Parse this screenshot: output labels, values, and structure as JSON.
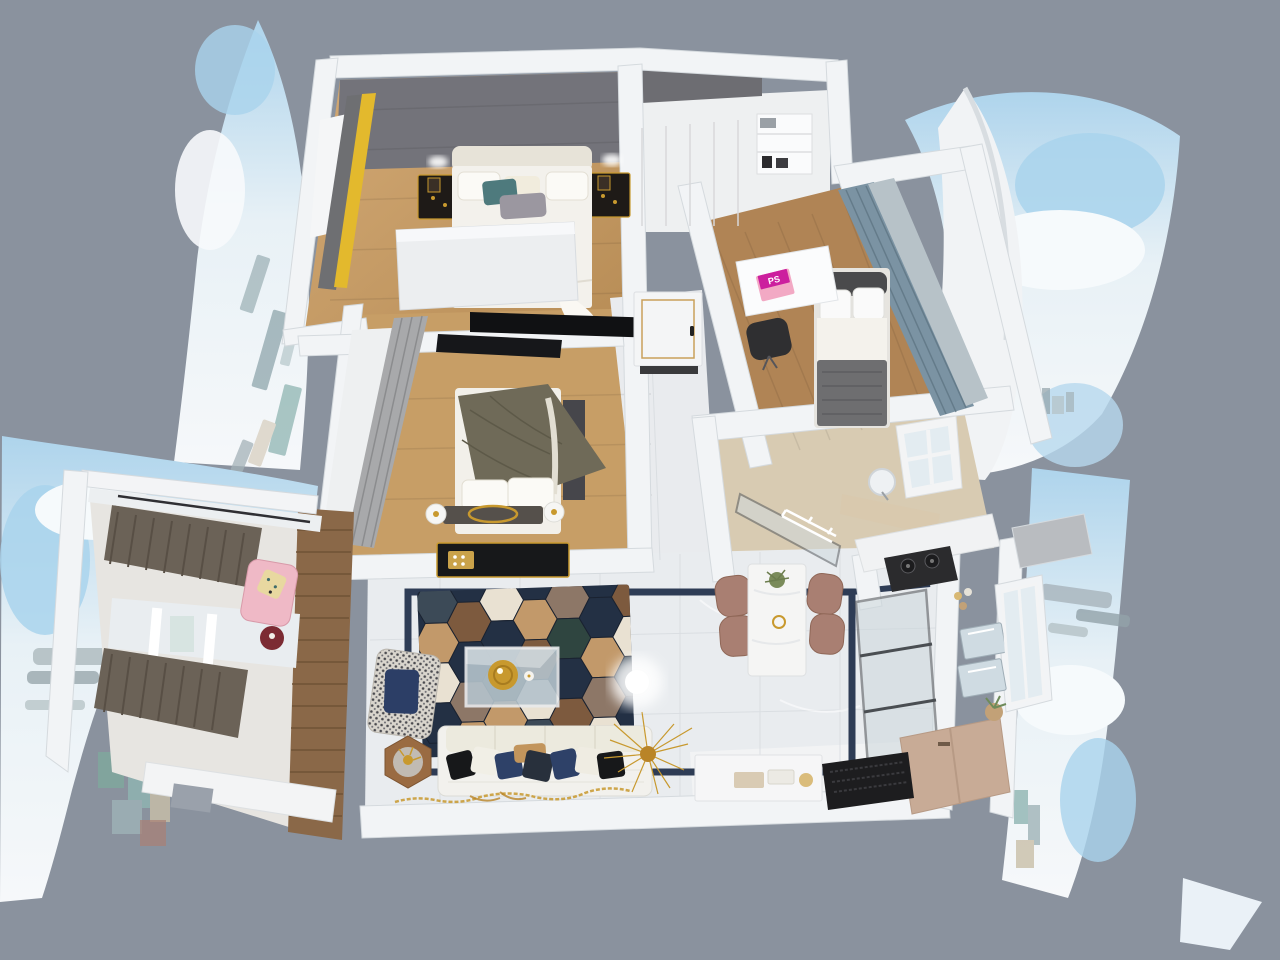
{
  "scene": {
    "description": "top-down dollhouse 3D render of a furnished apartment surrounded by warped city-skyline panorama panels",
    "view": "overhead cutaway",
    "laptop": {
      "screen_text": "PS",
      "body_color": "#f2a9c4",
      "screen_color": "#cc1f9e"
    }
  },
  "palette": {
    "background": "#8a929e",
    "wall": "#f2f4f6",
    "wall_edge": "#d5dade",
    "gray_wall": "#73737a",
    "wood_floor": "#c79e66",
    "wood_floor_dark": "#b08455",
    "marble": "#e9ecef",
    "beige_tile": "#d8cbb2",
    "navy_inlay": "#2e3c55",
    "rug_navy": "#233044",
    "rug_brown": "#7d5a3e",
    "rug_tan": "#c2996a",
    "rug_cream": "#e9e1d2",
    "gold": "#c8992e",
    "yellow_curtain": "#e3b92d",
    "steel_curtain": "#7b93a3",
    "gray_curtain": "#a8a9ab",
    "brown_curtain": "#6b6257",
    "pink_chaise": "#efb9c6",
    "red_accent": "#7c2b33",
    "chair_mauve": "#a97f72",
    "cabinet_tan": "#c8ab96",
    "near_black": "#1d1d1f",
    "bed_white": "#f3f1ec",
    "olive_blanket": "#6f6a58",
    "gray_blanket": "#6e6e70",
    "teal_pillow": "#4e7a7d",
    "navy_pillow": "#2e4168",
    "sky_blue": "#a9d3ec",
    "cloud": "#f4f8fb",
    "city_tower": "#a4b2b8",
    "glass": "#ccd7dc",
    "wood_slat": "#8a6848"
  },
  "rooms": [
    {
      "name": "master-bedroom",
      "items": [
        "double-bed",
        "upholstered-headboard",
        "white-pillows",
        "teal-pillow",
        "gray-pillow",
        "black-gold-nightstand-left",
        "black-gold-nightstand-right",
        "wall-sconces",
        "yellow-curtain",
        "gray-drape",
        "tilted-wardrobe-panel",
        "wall-tv-screens"
      ]
    },
    {
      "name": "closet-hall",
      "items": [
        "white-wardrobe",
        "open-shelving",
        "books"
      ]
    },
    {
      "name": "small-bedroom",
      "items": [
        "single-bed-gray-blanket",
        "white-pillows",
        "desk",
        "pink-laptop",
        "desk-chair",
        "steel-blue-window-curtains"
      ]
    },
    {
      "name": "second-bedroom",
      "items": [
        "double-bed-olive-blanket",
        "foot-bench-gold-oval",
        "round-lamps",
        "gray-curtains",
        "wardrobe-mirror",
        "black-gold-tv-console"
      ]
    },
    {
      "name": "hallway",
      "items": [
        "interior-door-gold-trim",
        "door-handle",
        "doormat",
        "marble-tiles"
      ]
    },
    {
      "name": "bathroom",
      "items": [
        "round-mirror",
        "vanity-counter",
        "shower-glass",
        "drying-rack",
        "window"
      ]
    },
    {
      "name": "living-room",
      "items": [
        "hexagon-rug",
        "glass-coffee-table",
        "gold-round-tray",
        "white-sofa",
        "throw-pillows",
        "houndstooth-armchair",
        "navy-cushion",
        "hexagon-side-table",
        "gold-branch-decor",
        "ceiling-light-glow",
        "navy-floor-inlay",
        "gold-scatter-runner"
      ]
    },
    {
      "name": "dining-area",
      "items": [
        "marble-dining-table",
        "mauve-chairs-x4",
        "plant-centerpiece",
        "gold-cup"
      ]
    },
    {
      "name": "kitchen",
      "items": [
        "gas-cooktop",
        "glass-partition-doors",
        "white-counters",
        "wall-appliances",
        "beige-cabinet",
        "potted-plant",
        "stone-counter-slab",
        "window-wall"
      ]
    },
    {
      "name": "entrance",
      "items": [
        "black-doormat",
        "shoe-cabinet",
        "tray-items"
      ]
    },
    {
      "name": "balcony-lounge",
      "items": [
        "brown-curtains-upper",
        "brown-curtains-lower",
        "pink-chaise",
        "patterned-pillow",
        "red-round-side-table",
        "wood-slat-wall",
        "white-cabinets"
      ]
    }
  ],
  "panoramas": {
    "style": "warped sky and city skyline photo panels",
    "positions": [
      "top-left-sail",
      "left-crescent",
      "top-right-fan",
      "right-sheet",
      "bottom-right-sliver"
    ]
  }
}
